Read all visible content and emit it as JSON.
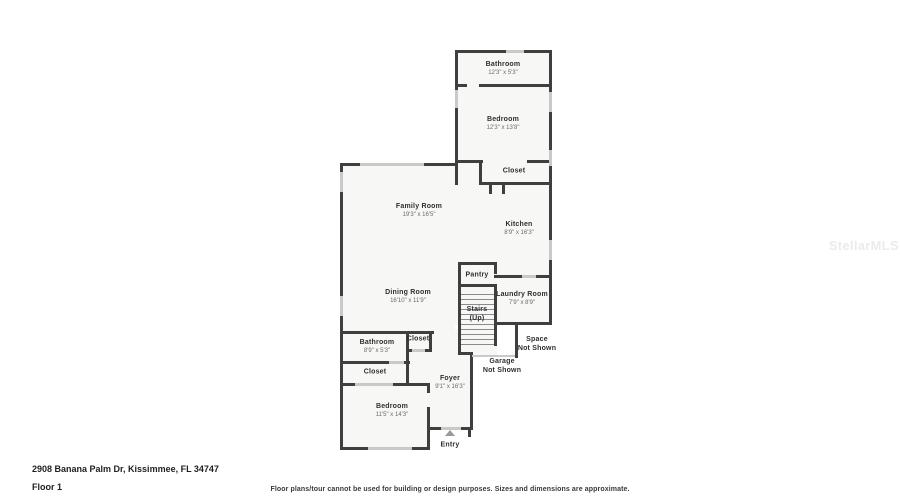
{
  "meta": {
    "address": "2908 Banana Palm Dr, Kissimmee, FL 34747",
    "floor_label": "Floor 1",
    "disclaimer": "Floor plans/tour cannot be used for building or design purposes. Sizes and dimensions are approximate.",
    "watermark": "StellarMLS"
  },
  "colors": {
    "wall": "#3f3f3f",
    "room_fill": "#f7f7f6",
    "window": "#c9c9c9",
    "label_text": "#2f2f2f",
    "dims_text": "#6a6a6a"
  },
  "rooms": [
    {
      "id": "bathroom-upper",
      "label": "Bathroom",
      "dims": "12'3\" x 5'3\"",
      "x": 503,
      "y": 69
    },
    {
      "id": "bedroom-upper",
      "label": "Bedroom",
      "dims": "12'3\" x 13'8\"",
      "x": 503,
      "y": 124
    },
    {
      "id": "closet-upper",
      "label": "Closet",
      "dims": "",
      "x": 514,
      "y": 171
    },
    {
      "id": "family-room",
      "label": "Family Room",
      "dims": "19'3\" x 16'5\"",
      "x": 419,
      "y": 211
    },
    {
      "id": "kitchen",
      "label": "Kitchen",
      "dims": "8'9\" x 16'3\"",
      "x": 519,
      "y": 229
    },
    {
      "id": "pantry",
      "label": "Pantry",
      "dims": "",
      "x": 477,
      "y": 275
    },
    {
      "id": "dining-room",
      "label": "Dining Room",
      "dims": "16'10\" x 11'9\"",
      "x": 408,
      "y": 297
    },
    {
      "id": "laundry-room",
      "label": "Laundry Room",
      "dims": "7'9\" x 8'9\"",
      "x": 522,
      "y": 299
    },
    {
      "id": "stairs",
      "label": "Stairs\n(Up)",
      "dims": "",
      "x": 477,
      "y": 314
    },
    {
      "id": "closet-hall",
      "label": "Closet",
      "dims": "",
      "x": 418,
      "y": 339
    },
    {
      "id": "bathroom-lower",
      "label": "Bathroom",
      "dims": "8'9\" x 5'3\"",
      "x": 377,
      "y": 347
    },
    {
      "id": "space-not-shown",
      "label": "Space\nNot Shown",
      "dims": "",
      "x": 537,
      "y": 344
    },
    {
      "id": "garage-not-shown",
      "label": "Garage\nNot Shown",
      "dims": "",
      "x": 502,
      "y": 366
    },
    {
      "id": "closet-lower",
      "label": "Closet",
      "dims": "",
      "x": 375,
      "y": 372
    },
    {
      "id": "foyer",
      "label": "Foyer",
      "dims": "9'1\" x 16'3\"",
      "x": 450,
      "y": 383
    },
    {
      "id": "bedroom-lower",
      "label": "Bedroom",
      "dims": "11'5\" x 14'3\"",
      "x": 392,
      "y": 411
    },
    {
      "id": "entry",
      "label": "Entry",
      "dims": "",
      "x": 450,
      "y": 445
    }
  ]
}
